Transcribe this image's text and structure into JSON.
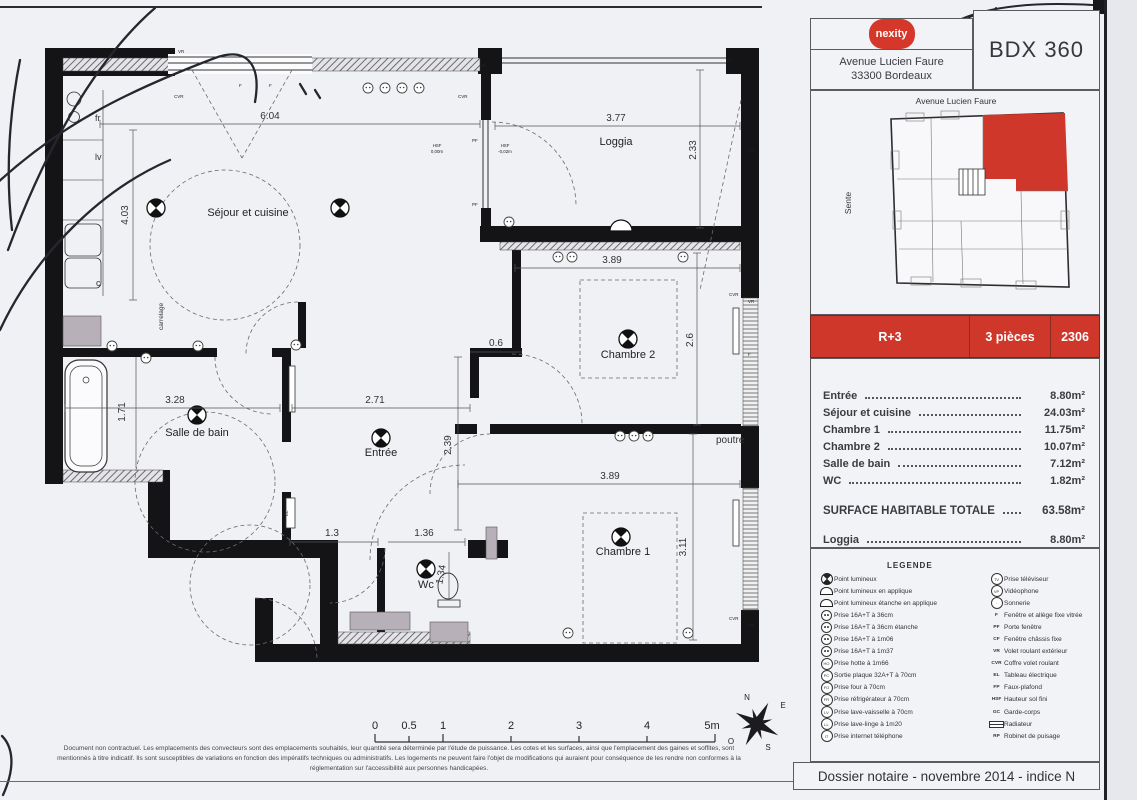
{
  "header": {
    "logo_text": "nexity",
    "address_line1": "Avenue Lucien Faure",
    "address_line2": "33300 Bordeaux",
    "project_title": "BDX 360"
  },
  "key_plan": {
    "street_top": "Avenue Lucien Faure",
    "street_left": "Sente",
    "highlight_color": "#cf372b"
  },
  "unit_bar": {
    "floor": "R+3",
    "rooms": "3 pièces",
    "unit_number": "2306"
  },
  "areas": {
    "rows": [
      {
        "label": "Entrée",
        "value": "8.80m²"
      },
      {
        "label": "Séjour et cuisine",
        "value": "24.03m²"
      },
      {
        "label": "Chambre 1",
        "value": "11.75m²"
      },
      {
        "label": "Chambre 2",
        "value": "10.07m²"
      },
      {
        "label": "Salle de bain",
        "value": "7.12m²"
      },
      {
        "label": "WC",
        "value": "1.82m²"
      }
    ],
    "total_label": "SURFACE HABITABLE TOTALE",
    "total_value": "63.58m²",
    "loggia_label": "Loggia",
    "loggia_value": "8.80m²"
  },
  "legend": {
    "title": "LEGENDE",
    "left": [
      {
        "code": "",
        "label": "Point lumineux"
      },
      {
        "code": "",
        "label": "Point lumineux en applique"
      },
      {
        "code": "",
        "label": "Point lumineux étanche en applique"
      },
      {
        "code": "",
        "label": "Prise 16A+T à 36cm"
      },
      {
        "code": "",
        "label": "Prise 16A+T à 36cm étanche"
      },
      {
        "code": "",
        "label": "Prise 16A+T à 1m06"
      },
      {
        "code": "",
        "label": "Prise 16A+T à 1m37"
      },
      {
        "code": "HO",
        "label": "Prise hotte à 1m66"
      },
      {
        "code": "PC",
        "label": "Sortie plaque 32A+T à 70cm"
      },
      {
        "code": "FO",
        "label": "Prise four à 70cm"
      },
      {
        "code": "FR",
        "label": "Prise réfrigérateur à 70cm"
      },
      {
        "code": "LV",
        "label": "Prise lave-vaisselle à 70cm"
      },
      {
        "code": "LL",
        "label": "Prise lave-linge à 1m20"
      },
      {
        "code": "IT",
        "label": "Prise internet téléphone"
      }
    ],
    "right": [
      {
        "code": "TV",
        "label": "Prise téléviseur"
      },
      {
        "code": "VP",
        "label": "Vidéophone"
      },
      {
        "code": "·",
        "label": "Sonnerie"
      },
      {
        "code": "F",
        "label": "Fenêtre et allège fixe vitrée"
      },
      {
        "code": "PF",
        "label": "Porte fenêtre"
      },
      {
        "code": "CF",
        "label": "Fenêtre châssis fixe"
      },
      {
        "code": "VR",
        "label": "Volet roulant extérieur"
      },
      {
        "code": "CVR",
        "label": "Coffre volet roulant"
      },
      {
        "code": "EL",
        "label": "Tableau électrique"
      },
      {
        "code": "FP",
        "label": "Faux-plafond"
      },
      {
        "code": "HSF",
        "label": "Hauteur sol fini"
      },
      {
        "code": "GC",
        "label": "Garde-corps"
      },
      {
        "code": "",
        "label": "Radiateur"
      },
      {
        "code": "RP",
        "label": "Robinet de puisage"
      }
    ]
  },
  "footer": {
    "dossier": "Dossier notaire - novembre 2014 - indice N",
    "disclaimer_line1": "Document non contractuel. Les emplacements des convecteurs sont des emplacements souhaités, leur quantité sera déterminée par l'étude de puissance. Les cotes et les surfaces, ainsi que l'emplacement des gaines et soffites, sont",
    "disclaimer_line2": "mentionnés à titre indicatif. Ils sont susceptibles de variations en fonction des impératifs techniques ou administratifs. Les logements ne peuvent faire l'objet de modifications qui auraient pour conséquence de les rendre non conformes à la",
    "disclaimer_line3": "réglementation sur l'accessibilité aux personnes handicapées."
  },
  "plan": {
    "room_labels": {
      "sejour": "Séjour et cuisine",
      "loggia": "Loggia",
      "chambre2": "Chambre 2",
      "chambre1": "Chambre 1",
      "sdb": "Salle de bain",
      "entree": "Entrée",
      "wc": "Wc"
    },
    "annotations": {
      "poutre": "poutre",
      "carrelage": "carrelage",
      "fr": "fr",
      "lv": "lv",
      "c": "c",
      "hsf": "HSF",
      "hsf_sejour_val": "0,00m",
      "hsf_loggia_val": "-0,02m"
    },
    "dimensions": {
      "sejour_w": "6.04",
      "sejour_h": "4.03",
      "loggia_w": "3.77",
      "loggia_h": "2.33",
      "ch2_w": "3.89",
      "ch2_h": "2.6",
      "couloir": "0.6",
      "sdb_w": "3.28",
      "sdb_h": "1.71",
      "entree_w": "2.71",
      "entree_h": "2.39",
      "ch1_w": "3.89",
      "ch1_h": "3.11",
      "dress_w": "1.3",
      "wc_w": "1.36",
      "wc_h": "1.34"
    },
    "wall_tags": {
      "vr": "VR",
      "cvr": "CVR",
      "f": "F",
      "pf": "PF",
      "gc": "GC",
      "el": "EL"
    },
    "scale_ticks": [
      "0",
      "0.5",
      "1",
      "2",
      "3",
      "4",
      "5m"
    ],
    "compass": {
      "n": "N",
      "e": "E",
      "s": "S",
      "o": "O"
    }
  }
}
